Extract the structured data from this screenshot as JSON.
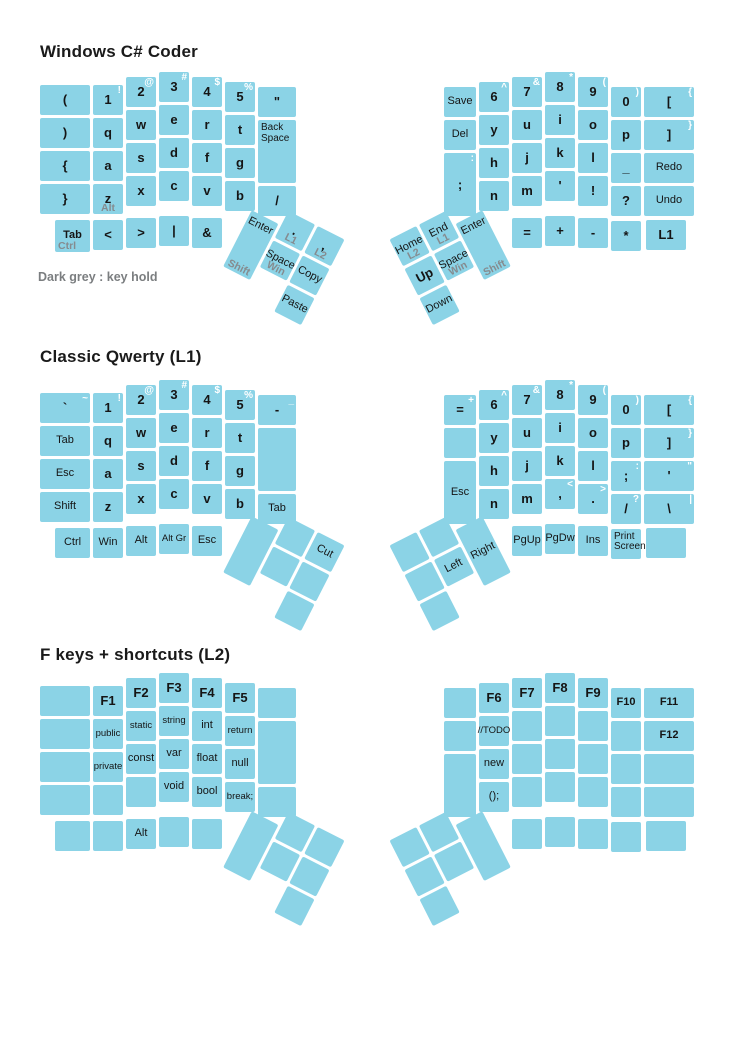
{
  "diagram": {
    "type": "split-ergonomic-keyboard-layout",
    "key_color": "#8bd3e6",
    "shift_label_color": "#ffffff",
    "hold_label_color": "#858b8f",
    "note_color": "#7b7e80"
  },
  "layers": [
    {
      "id": "windows-csharp-coder",
      "title": "Windows C# Coder",
      "note": "Dark grey : key hold",
      "left_main": [
        {
          "c": 0,
          "r": 1,
          "m": "("
        },
        {
          "c": 0,
          "r": 2,
          "m": ")"
        },
        {
          "c": 0,
          "r": 3,
          "m": "{"
        },
        {
          "c": 0,
          "r": 4,
          "m": "}"
        },
        {
          "c": 1,
          "r": 1,
          "m": "1",
          "s": "!"
        },
        {
          "c": 1,
          "r": 2,
          "m": "q"
        },
        {
          "c": 1,
          "r": 3,
          "m": "a"
        },
        {
          "c": 1,
          "r": 4,
          "m": "z",
          "h": "Alt"
        },
        {
          "c": 2,
          "r": 1,
          "m": "2",
          "s": "@"
        },
        {
          "c": 2,
          "r": 2,
          "m": "w"
        },
        {
          "c": 2,
          "r": 3,
          "m": "s"
        },
        {
          "c": 2,
          "r": 4,
          "m": "x"
        },
        {
          "c": 3,
          "r": 1,
          "m": "3",
          "s": "#"
        },
        {
          "c": 3,
          "r": 2,
          "m": "e"
        },
        {
          "c": 3,
          "r": 3,
          "m": "d"
        },
        {
          "c": 3,
          "r": 4,
          "m": "c"
        },
        {
          "c": 4,
          "r": 1,
          "m": "4",
          "s": "$"
        },
        {
          "c": 4,
          "r": 2,
          "m": "r"
        },
        {
          "c": 4,
          "r": 3,
          "m": "f"
        },
        {
          "c": 4,
          "r": 4,
          "m": "v"
        },
        {
          "c": 5,
          "r": 1,
          "m": "5",
          "s": "%"
        },
        {
          "c": 5,
          "r": 2,
          "m": "t"
        },
        {
          "c": 5,
          "r": 3,
          "m": "g"
        },
        {
          "c": 5,
          "r": 4,
          "m": "b"
        },
        {
          "c": 6,
          "r": 1,
          "m": "\""
        },
        {
          "c": 6,
          "r": 2,
          "m": "Back Space",
          "t": 2
        },
        {
          "c": 6,
          "r": 4,
          "m": "/"
        },
        {
          "pos": "mod",
          "r": 5,
          "m": "Tab",
          "h": "Ctrl",
          "b": 1
        },
        {
          "c": 1,
          "r": 5,
          "m": "<"
        },
        {
          "c": 2,
          "r": 5,
          "m": ">"
        },
        {
          "c": 3,
          "r": 5,
          "m": "|"
        },
        {
          "c": 4,
          "r": 5,
          "m": "&"
        }
      ],
      "right_main": [
        {
          "c": 0,
          "r": 1,
          "m": "Save"
        },
        {
          "c": 0,
          "r": 2,
          "m": "Del"
        },
        {
          "c": 0,
          "r": 3,
          "m": ";",
          "s": ":",
          "t": 2
        },
        {
          "c": 1,
          "r": 1,
          "m": "6",
          "s": "^"
        },
        {
          "c": 1,
          "r": 2,
          "m": "y"
        },
        {
          "c": 1,
          "r": 3,
          "m": "h"
        },
        {
          "c": 1,
          "r": 4,
          "m": "n"
        },
        {
          "c": 2,
          "r": 1,
          "m": "7",
          "s": "&"
        },
        {
          "c": 2,
          "r": 2,
          "m": "u"
        },
        {
          "c": 2,
          "r": 3,
          "m": "j"
        },
        {
          "c": 2,
          "r": 4,
          "m": "m"
        },
        {
          "c": 3,
          "r": 1,
          "m": "8",
          "s": "*"
        },
        {
          "c": 3,
          "r": 2,
          "m": "i"
        },
        {
          "c": 3,
          "r": 3,
          "m": "k"
        },
        {
          "c": 3,
          "r": 4,
          "m": "'"
        },
        {
          "c": 4,
          "r": 1,
          "m": "9",
          "s": "("
        },
        {
          "c": 4,
          "r": 2,
          "m": "o"
        },
        {
          "c": 4,
          "r": 3,
          "m": "l"
        },
        {
          "c": 4,
          "r": 4,
          "m": "!"
        },
        {
          "c": 5,
          "r": 1,
          "m": "0",
          "s": ")"
        },
        {
          "c": 5,
          "r": 2,
          "m": "p"
        },
        {
          "c": 5,
          "r": 3,
          "m": "_"
        },
        {
          "c": 5,
          "r": 4,
          "m": "?"
        },
        {
          "c": 6,
          "r": 1,
          "m": "[",
          "s": "{"
        },
        {
          "c": 6,
          "r": 2,
          "m": "]",
          "s": "}"
        },
        {
          "c": 6,
          "r": 3,
          "m": "Redo"
        },
        {
          "c": 6,
          "r": 4,
          "m": "Undo"
        },
        {
          "c": 2,
          "r": 5,
          "m": "="
        },
        {
          "c": 3,
          "r": 5,
          "m": "+"
        },
        {
          "c": 4,
          "r": 5,
          "m": "-"
        },
        {
          "c": 5,
          "r": 5,
          "m": "*"
        },
        {
          "pos": "mod",
          "r": 5,
          "m": "L1"
        }
      ],
      "left_thumb": [
        {
          "c": 1,
          "r": 1,
          "m": "Enter",
          "h": "Shift",
          "t": 2,
          "dy": 16
        },
        {
          "c": 2,
          "r": 1,
          "m": ".",
          "h": "L1"
        },
        {
          "c": 3,
          "r": 1,
          "m": ",",
          "h": "L2"
        },
        {
          "c": 2,
          "r": 2,
          "m": "Space",
          "h": "Win"
        },
        {
          "c": 3,
          "r": 2,
          "m": "Copy"
        },
        {
          "c": 3,
          "r": 3,
          "m": "Paste"
        }
      ],
      "right_thumb": [
        {
          "c": 1,
          "r": 1,
          "m": "Home",
          "h": "L2"
        },
        {
          "c": 2,
          "r": 1,
          "m": "End",
          "h": "L1"
        },
        {
          "c": 1,
          "r": 2,
          "m": "Up"
        },
        {
          "c": 2,
          "r": 2,
          "m": "Space",
          "h": "Win"
        },
        {
          "c": 3,
          "r": 1,
          "m": "Enter",
          "h": "Shift",
          "t": 2,
          "dy": 16
        },
        {
          "c": 1,
          "r": 3,
          "m": "Down"
        }
      ]
    },
    {
      "id": "classic-qwerty-l1",
      "title": "Classic Qwerty (L1)",
      "note": "",
      "left_main": [
        {
          "c": 0,
          "r": 1,
          "m": "`",
          "s": "~"
        },
        {
          "c": 0,
          "r": 2,
          "m": "Tab"
        },
        {
          "c": 0,
          "r": 3,
          "m": "Esc"
        },
        {
          "c": 0,
          "r": 4,
          "m": "Shift"
        },
        {
          "c": 1,
          "r": 1,
          "m": "1",
          "s": "!"
        },
        {
          "c": 1,
          "r": 2,
          "m": "q"
        },
        {
          "c": 1,
          "r": 3,
          "m": "a"
        },
        {
          "c": 1,
          "r": 4,
          "m": "z"
        },
        {
          "c": 2,
          "r": 1,
          "m": "2",
          "s": "@"
        },
        {
          "c": 2,
          "r": 2,
          "m": "w"
        },
        {
          "c": 2,
          "r": 3,
          "m": "s"
        },
        {
          "c": 2,
          "r": 4,
          "m": "x"
        },
        {
          "c": 3,
          "r": 1,
          "m": "3",
          "s": "#"
        },
        {
          "c": 3,
          "r": 2,
          "m": "e"
        },
        {
          "c": 3,
          "r": 3,
          "m": "d"
        },
        {
          "c": 3,
          "r": 4,
          "m": "c"
        },
        {
          "c": 4,
          "r": 1,
          "m": "4",
          "s": "$"
        },
        {
          "c": 4,
          "r": 2,
          "m": "r"
        },
        {
          "c": 4,
          "r": 3,
          "m": "f"
        },
        {
          "c": 4,
          "r": 4,
          "m": "v"
        },
        {
          "c": 5,
          "r": 1,
          "m": "5",
          "s": "%"
        },
        {
          "c": 5,
          "r": 2,
          "m": "t"
        },
        {
          "c": 5,
          "r": 3,
          "m": "g"
        },
        {
          "c": 5,
          "r": 4,
          "m": "b"
        },
        {
          "c": 6,
          "r": 1,
          "m": "-",
          "s": "_"
        },
        {
          "c": 6,
          "r": 2,
          "m": "",
          "t": 2
        },
        {
          "c": 6,
          "r": 4,
          "m": "Tab"
        },
        {
          "pos": "mod",
          "r": 5,
          "m": "Ctrl"
        },
        {
          "c": 1,
          "r": 5,
          "m": "Win"
        },
        {
          "c": 2,
          "r": 5,
          "m": "Alt"
        },
        {
          "c": 3,
          "r": 5,
          "m": "Alt Gr"
        },
        {
          "c": 4,
          "r": 5,
          "m": "Esc"
        }
      ],
      "right_main": [
        {
          "c": 0,
          "r": 1,
          "m": "=",
          "s": "+"
        },
        {
          "c": 0,
          "r": 2,
          "m": ""
        },
        {
          "c": 0,
          "r": 3,
          "m": "Esc",
          "t": 2
        },
        {
          "c": 1,
          "r": 1,
          "m": "6",
          "s": "^"
        },
        {
          "c": 1,
          "r": 2,
          "m": "y"
        },
        {
          "c": 1,
          "r": 3,
          "m": "h"
        },
        {
          "c": 1,
          "r": 4,
          "m": "n"
        },
        {
          "c": 2,
          "r": 1,
          "m": "7",
          "s": "&"
        },
        {
          "c": 2,
          "r": 2,
          "m": "u"
        },
        {
          "c": 2,
          "r": 3,
          "m": "j"
        },
        {
          "c": 2,
          "r": 4,
          "m": "m"
        },
        {
          "c": 3,
          "r": 1,
          "m": "8",
          "s": "*"
        },
        {
          "c": 3,
          "r": 2,
          "m": "i"
        },
        {
          "c": 3,
          "r": 3,
          "m": "k"
        },
        {
          "c": 3,
          "r": 4,
          "m": ",",
          "s": "<"
        },
        {
          "c": 4,
          "r": 1,
          "m": "9",
          "s": "("
        },
        {
          "c": 4,
          "r": 2,
          "m": "o"
        },
        {
          "c": 4,
          "r": 3,
          "m": "l"
        },
        {
          "c": 4,
          "r": 4,
          "m": ".",
          "s": ">"
        },
        {
          "c": 5,
          "r": 1,
          "m": "0",
          "s": ")"
        },
        {
          "c": 5,
          "r": 2,
          "m": "p"
        },
        {
          "c": 5,
          "r": 3,
          "m": ";",
          "s": ":"
        },
        {
          "c": 5,
          "r": 4,
          "m": "/",
          "s": "?"
        },
        {
          "c": 6,
          "r": 1,
          "m": "[",
          "s": "{"
        },
        {
          "c": 6,
          "r": 2,
          "m": "]",
          "s": "}"
        },
        {
          "c": 6,
          "r": 3,
          "m": "'",
          "s": "\""
        },
        {
          "c": 6,
          "r": 4,
          "m": "\\",
          "s": "|"
        },
        {
          "c": 2,
          "r": 5,
          "m": "PgUp"
        },
        {
          "c": 3,
          "r": 5,
          "m": "PgDw"
        },
        {
          "c": 4,
          "r": 5,
          "m": "Ins"
        },
        {
          "c": 5,
          "r": 5,
          "m": "Print Screen"
        },
        {
          "pos": "mod",
          "r": 5,
          "m": ""
        }
      ],
      "left_thumb": [
        {
          "c": 1,
          "r": 1,
          "m": "",
          "t": 2,
          "dy": 16
        },
        {
          "c": 2,
          "r": 1,
          "m": ""
        },
        {
          "c": 3,
          "r": 1,
          "m": "Cut"
        },
        {
          "c": 2,
          "r": 2,
          "m": ""
        },
        {
          "c": 3,
          "r": 2,
          "m": ""
        },
        {
          "c": 3,
          "r": 3,
          "m": ""
        }
      ],
      "right_thumb": [
        {
          "c": 1,
          "r": 1,
          "m": ""
        },
        {
          "c": 2,
          "r": 1,
          "m": ""
        },
        {
          "c": 1,
          "r": 2,
          "m": ""
        },
        {
          "c": 2,
          "r": 2,
          "m": "Left"
        },
        {
          "c": 3,
          "r": 1,
          "m": "Right",
          "t": 2,
          "dy": 16
        },
        {
          "c": 1,
          "r": 3,
          "m": ""
        }
      ]
    },
    {
      "id": "fkeys-shortcuts-l2",
      "title": "F keys + shortcuts (L2)",
      "note": "",
      "left_main": [
        {
          "c": 0,
          "r": 1,
          "m": ""
        },
        {
          "c": 0,
          "r": 2,
          "m": ""
        },
        {
          "c": 0,
          "r": 3,
          "m": ""
        },
        {
          "c": 0,
          "r": 4,
          "m": ""
        },
        {
          "c": 1,
          "r": 1,
          "m": "F1"
        },
        {
          "c": 1,
          "r": 2,
          "m": "public"
        },
        {
          "c": 1,
          "r": 3,
          "m": "private"
        },
        {
          "c": 1,
          "r": 4,
          "m": ""
        },
        {
          "c": 2,
          "r": 1,
          "m": "F2"
        },
        {
          "c": 2,
          "r": 2,
          "m": "static"
        },
        {
          "c": 2,
          "r": 3,
          "m": "const"
        },
        {
          "c": 2,
          "r": 4,
          "m": ""
        },
        {
          "c": 3,
          "r": 1,
          "m": "F3"
        },
        {
          "c": 3,
          "r": 2,
          "m": "string"
        },
        {
          "c": 3,
          "r": 3,
          "m": "var"
        },
        {
          "c": 3,
          "r": 4,
          "m": "void"
        },
        {
          "c": 4,
          "r": 1,
          "m": "F4"
        },
        {
          "c": 4,
          "r": 2,
          "m": "int"
        },
        {
          "c": 4,
          "r": 3,
          "m": "float"
        },
        {
          "c": 4,
          "r": 4,
          "m": "bool"
        },
        {
          "c": 5,
          "r": 1,
          "m": "F5"
        },
        {
          "c": 5,
          "r": 2,
          "m": "return"
        },
        {
          "c": 5,
          "r": 3,
          "m": "null"
        },
        {
          "c": 5,
          "r": 4,
          "m": "break;"
        },
        {
          "c": 6,
          "r": 1,
          "m": ""
        },
        {
          "c": 6,
          "r": 2,
          "m": "",
          "t": 2
        },
        {
          "c": 6,
          "r": 4,
          "m": ""
        },
        {
          "pos": "mod",
          "r": 5,
          "m": ""
        },
        {
          "c": 1,
          "r": 5,
          "m": ""
        },
        {
          "c": 2,
          "r": 5,
          "m": "Alt"
        },
        {
          "c": 3,
          "r": 5,
          "m": ""
        },
        {
          "c": 4,
          "r": 5,
          "m": ""
        }
      ],
      "right_main": [
        {
          "c": 0,
          "r": 1,
          "m": ""
        },
        {
          "c": 0,
          "r": 2,
          "m": ""
        },
        {
          "c": 0,
          "r": 3,
          "m": "",
          "t": 2
        },
        {
          "c": 1,
          "r": 1,
          "m": "F6"
        },
        {
          "c": 1,
          "r": 2,
          "m": "//TODO"
        },
        {
          "c": 1,
          "r": 3,
          "m": "new"
        },
        {
          "c": 1,
          "r": 4,
          "m": "();"
        },
        {
          "c": 2,
          "r": 1,
          "m": "F7"
        },
        {
          "c": 2,
          "r": 2,
          "m": ""
        },
        {
          "c": 2,
          "r": 3,
          "m": ""
        },
        {
          "c": 2,
          "r": 4,
          "m": ""
        },
        {
          "c": 3,
          "r": 1,
          "m": "F8"
        },
        {
          "c": 3,
          "r": 2,
          "m": ""
        },
        {
          "c": 3,
          "r": 3,
          "m": ""
        },
        {
          "c": 3,
          "r": 4,
          "m": ""
        },
        {
          "c": 4,
          "r": 1,
          "m": "F9"
        },
        {
          "c": 4,
          "r": 2,
          "m": ""
        },
        {
          "c": 4,
          "r": 3,
          "m": ""
        },
        {
          "c": 4,
          "r": 4,
          "m": ""
        },
        {
          "c": 5,
          "r": 1,
          "m": "F10"
        },
        {
          "c": 5,
          "r": 2,
          "m": ""
        },
        {
          "c": 5,
          "r": 3,
          "m": ""
        },
        {
          "c": 5,
          "r": 4,
          "m": ""
        },
        {
          "c": 6,
          "r": 1,
          "m": "F11"
        },
        {
          "c": 6,
          "r": 2,
          "m": "F12"
        },
        {
          "c": 6,
          "r": 3,
          "m": ""
        },
        {
          "c": 6,
          "r": 4,
          "m": ""
        },
        {
          "c": 2,
          "r": 5,
          "m": ""
        },
        {
          "c": 3,
          "r": 5,
          "m": ""
        },
        {
          "c": 4,
          "r": 5,
          "m": ""
        },
        {
          "c": 5,
          "r": 5,
          "m": ""
        },
        {
          "pos": "mod",
          "r": 5,
          "m": ""
        }
      ],
      "left_thumb": [
        {
          "c": 1,
          "r": 1,
          "m": "",
          "t": 2,
          "dy": 16
        },
        {
          "c": 2,
          "r": 1,
          "m": ""
        },
        {
          "c": 3,
          "r": 1,
          "m": ""
        },
        {
          "c": 2,
          "r": 2,
          "m": ""
        },
        {
          "c": 3,
          "r": 2,
          "m": ""
        },
        {
          "c": 3,
          "r": 3,
          "m": ""
        }
      ],
      "right_thumb": [
        {
          "c": 1,
          "r": 1,
          "m": ""
        },
        {
          "c": 2,
          "r": 1,
          "m": ""
        },
        {
          "c": 1,
          "r": 2,
          "m": ""
        },
        {
          "c": 2,
          "r": 2,
          "m": ""
        },
        {
          "c": 3,
          "r": 1,
          "m": "",
          "t": 2,
          "dy": 16
        },
        {
          "c": 1,
          "r": 3,
          "m": ""
        }
      ]
    }
  ]
}
